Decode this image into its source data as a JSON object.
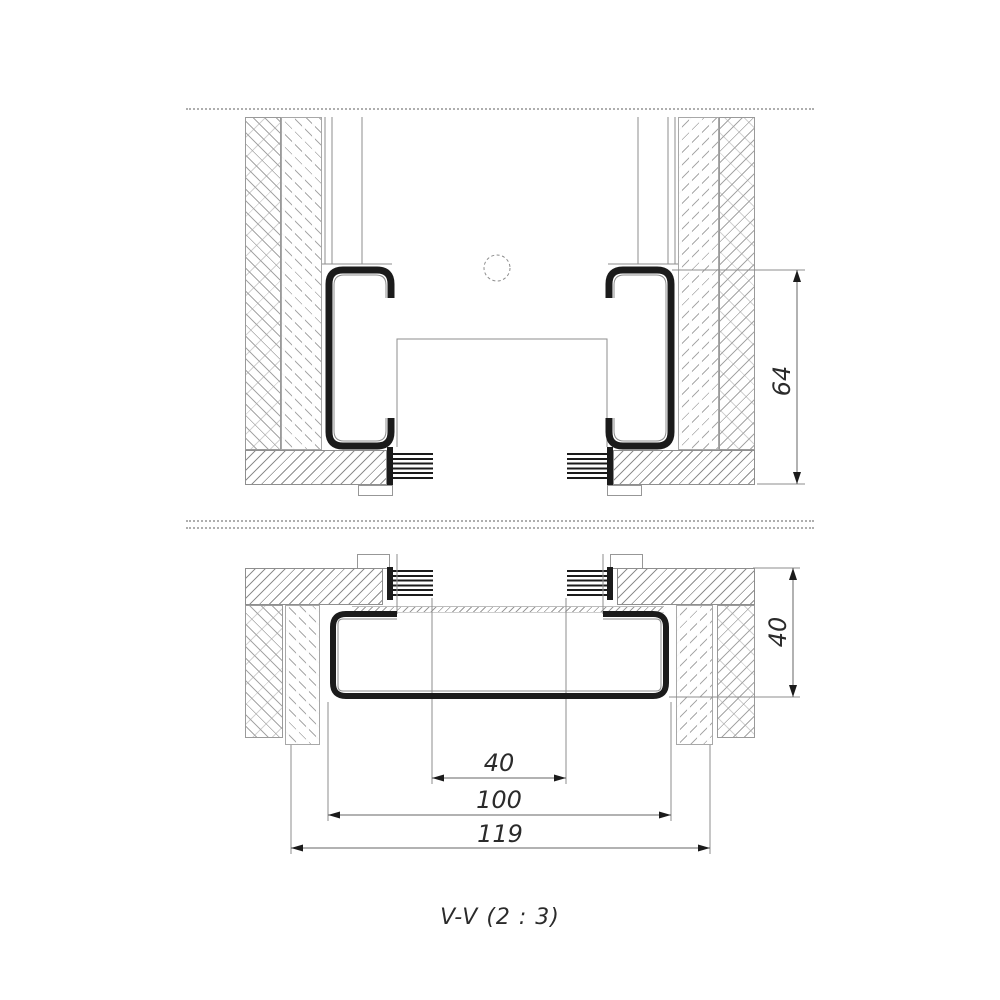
{
  "drawing": {
    "caption": "V-V (2 : 3)",
    "view_type": "section",
    "dimensions": {
      "upper_section_height": "64",
      "lower_profile_height": "40",
      "inner_gap_width": "40",
      "profile_width": "100",
      "overall_width": "119"
    },
    "colors": {
      "thick_line": "#1b1b1b",
      "thin_line": "#8d8d8d",
      "dim_line": "#666666",
      "hatch": "#a6a6a6"
    }
  }
}
